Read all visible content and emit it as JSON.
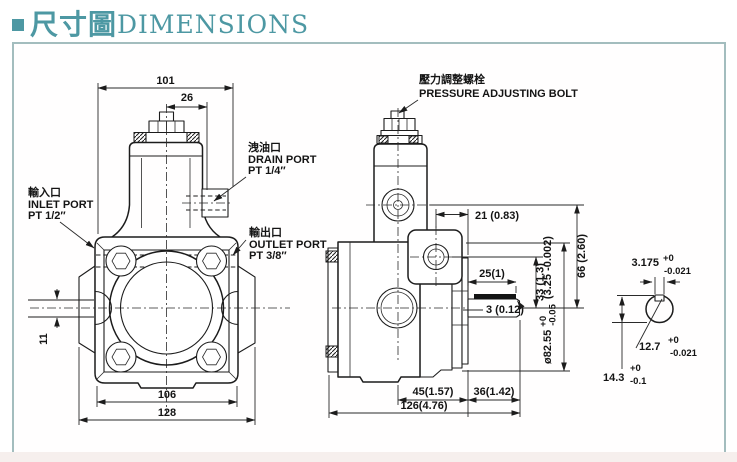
{
  "title": {
    "cjk": "尺寸圖",
    "en": "DIMENSIONS"
  },
  "front_view": {
    "dim_width_top": "101",
    "dim_valve_offset": "26",
    "dim_inlet_boss": "11",
    "dim_body_width": "106",
    "dim_overall_width": "128",
    "drain_port": {
      "cjk": "洩油口",
      "en": "DRAIN PORT",
      "thread": "PT 1/4″"
    },
    "inlet_port": {
      "cjk": "輸入口",
      "en": "INLET PORT",
      "thread": "PT 1/2″"
    },
    "outlet_port": {
      "cjk": "輸出口",
      "en": "OUTLET PORT",
      "thread": "PT 3/8″"
    }
  },
  "side_view": {
    "pressure_bolt": {
      "cjk": "壓力調整螺栓",
      "en": "PRESSURE ADJUSTING BOLT"
    },
    "dim_port_offset": "21 (0.83)",
    "dim_port_height": "66 (2.60)",
    "dim_outlet_height": "33 (1.3)",
    "dim_key_length": "25(1)",
    "dim_key_height": "3 (0.12)",
    "spigot_dia": {
      "main": "ø82.55",
      "plus": "+0",
      "minus": "-0.05",
      "inch": "(3.25 -0.002)"
    },
    "dim_body_depth": "45(1.57)",
    "dim_shaft_len": "36(1.42)",
    "dim_overall": "126(4.76)"
  },
  "shaft_detail": {
    "key_width": {
      "val": "3.175",
      "plus": "+0",
      "minus": "-0.021"
    },
    "shaft_dia": {
      "val": "12.7",
      "plus": "+0",
      "minus": "-0.021"
    },
    "shaft_height": {
      "val": "14.3",
      "plus": "+0",
      "minus": "-0.1"
    }
  }
}
